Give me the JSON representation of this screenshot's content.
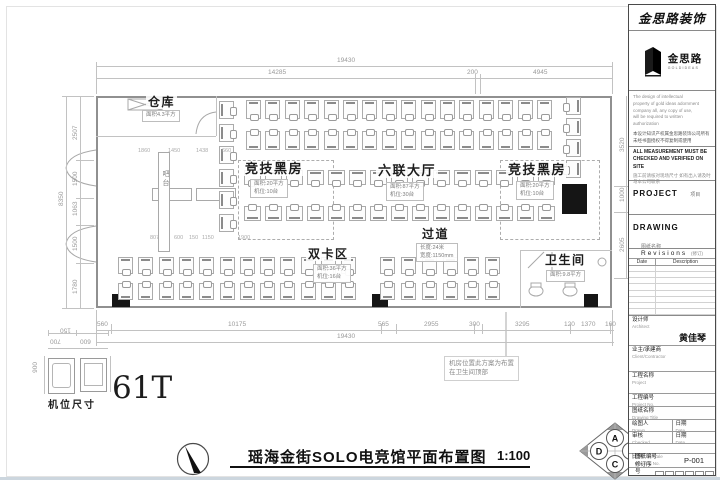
{
  "plan": {
    "rooms": [
      {
        "id": "warehouse",
        "label": "仓库",
        "fs": 12,
        "x": 146,
        "y": 96,
        "note": [
          "面积4.3平方"
        ],
        "nx": 142,
        "ny": 110
      },
      {
        "id": "dark-room-left",
        "label": "竞技黑房",
        "fs": 13,
        "x": 243,
        "y": 162,
        "note": [
          "面积:20平方",
          "机位:10台"
        ],
        "nx": 250,
        "ny": 179
      },
      {
        "id": "hall",
        "label": "六联大厅",
        "fs": 13,
        "x": 376,
        "y": 164,
        "note": [
          "面积:87平方",
          "机位:30台"
        ],
        "nx": 386,
        "ny": 182
      },
      {
        "id": "dark-room-right",
        "label": "竞技黑房",
        "fs": 13,
        "x": 506,
        "y": 163,
        "note": [
          "面积:20平方",
          "机位:10台"
        ],
        "nx": 516,
        "ny": 181
      },
      {
        "id": "corridor",
        "label": "过道",
        "fs": 12,
        "x": 420,
        "y": 228,
        "note": [
          "长度:24米",
          "宽度:1150mm"
        ],
        "nx": 416,
        "ny": 243
      },
      {
        "id": "dual-card-zone",
        "label": "双卡区",
        "fs": 12,
        "x": 306,
        "y": 248,
        "note": [
          "面积:36平方",
          "机位:16台"
        ],
        "nx": 313,
        "ny": 264
      },
      {
        "id": "restroom",
        "label": "卫生间",
        "fs": 12,
        "x": 543,
        "y": 254,
        "note": [
          "面积:9.8平方"
        ],
        "nx": 546,
        "ny": 270
      }
    ],
    "bar_label": "吧台",
    "machine_note": [
      "机房位置此方案为布置",
      "在卫生间顶部"
    ],
    "clusters": [
      {
        "x": 246,
        "y": 100,
        "n": 16,
        "dx": 19.4,
        "dy": 0,
        "w": 15,
        "h": 19,
        "c": "cb"
      },
      {
        "x": 246,
        "y": 131,
        "n": 16,
        "dx": 19.4,
        "dy": 0,
        "w": 15,
        "h": 19,
        "c": "ct"
      },
      {
        "x": 219,
        "y": 101,
        "n": 6,
        "dx": 0,
        "dy": 22.5,
        "w": 15,
        "h": 18,
        "c": "cr"
      },
      {
        "x": 566,
        "y": 97,
        "n": 4,
        "dx": 0,
        "dy": 21,
        "w": 15,
        "h": 18,
        "c": "cl"
      },
      {
        "x": 244,
        "y": 170,
        "n": 15,
        "dx": 21,
        "dy": 0,
        "w": 17,
        "h": 15,
        "c": "cb"
      },
      {
        "x": 244,
        "y": 206,
        "n": 15,
        "dx": 21,
        "dy": 0,
        "w": 17,
        "h": 15,
        "c": "ct"
      },
      {
        "x": 118,
        "y": 257,
        "n": 12,
        "dx": 20.3,
        "dy": 0,
        "w": 15,
        "h": 17,
        "c": "cb"
      },
      {
        "x": 118,
        "y": 283,
        "n": 12,
        "dx": 20.3,
        "dy": 0,
        "w": 15,
        "h": 17,
        "c": "ct"
      },
      {
        "x": 380,
        "y": 257,
        "n": 6,
        "dx": 21,
        "dy": 0,
        "w": 15,
        "h": 17,
        "c": "cb"
      },
      {
        "x": 380,
        "y": 283,
        "n": 6,
        "dx": 21,
        "dy": 0,
        "w": 15,
        "h": 17,
        "c": "ct"
      }
    ],
    "dims": [
      {
        "t": "19430",
        "x": 337,
        "y": 58
      },
      {
        "t": "14285",
        "x": 268,
        "y": 70
      },
      {
        "t": "200",
        "x": 467,
        "y": 70
      },
      {
        "t": "4945",
        "x": 533,
        "y": 70
      },
      {
        "t": "560",
        "x": 97,
        "y": 322
      },
      {
        "t": "10175",
        "x": 228,
        "y": 322
      },
      {
        "t": "565",
        "x": 378,
        "y": 322
      },
      {
        "t": "2955",
        "x": 424,
        "y": 322
      },
      {
        "t": "300",
        "x": 469,
        "y": 322
      },
      {
        "t": "3295",
        "x": 515,
        "y": 322
      },
      {
        "t": "120",
        "x": 564,
        "y": 322
      },
      {
        "t": "1370",
        "x": 581,
        "y": 322
      },
      {
        "t": "160",
        "x": 605,
        "y": 322
      },
      {
        "t": "19430",
        "x": 337,
        "y": 334
      },
      {
        "t": "2507",
        "x": 73,
        "y": 140,
        "cls": "rot"
      },
      {
        "t": "1500",
        "x": 73,
        "y": 186,
        "cls": "rot"
      },
      {
        "t": "1063",
        "x": 73,
        "y": 216,
        "cls": "rot"
      },
      {
        "t": "1500",
        "x": 73,
        "y": 251,
        "cls": "rot"
      },
      {
        "t": "1780",
        "x": 73,
        "y": 294,
        "cls": "rot"
      },
      {
        "t": "8350",
        "x": 59,
        "y": 206,
        "cls": "rot"
      },
      {
        "t": "3520",
        "x": 620,
        "y": 152,
        "cls": "rot"
      },
      {
        "t": "1000",
        "x": 620,
        "y": 202,
        "cls": "rot"
      },
      {
        "t": "2605",
        "x": 620,
        "y": 252,
        "cls": "rot"
      },
      {
        "t": "6325",
        "x": 632,
        "y": 202,
        "cls": "rot"
      },
      {
        "t": "1860",
        "x": 138,
        "y": 149,
        "cls": "tiny"
      },
      {
        "t": "1450",
        "x": 168,
        "y": 149,
        "cls": "tiny"
      },
      {
        "t": "1438",
        "x": 196,
        "y": 149,
        "cls": "tiny"
      },
      {
        "t": "660",
        "x": 222,
        "y": 149,
        "cls": "tiny"
      },
      {
        "t": "807",
        "x": 150,
        "y": 236,
        "cls": "tiny"
      },
      {
        "t": "600",
        "x": 174,
        "y": 236,
        "cls": "tiny"
      },
      {
        "t": "150",
        "x": 189,
        "y": 236,
        "cls": "tiny"
      },
      {
        "t": "1150",
        "x": 202,
        "y": 236,
        "cls": "tiny"
      },
      {
        "t": "1900",
        "x": 238,
        "y": 236,
        "cls": "tiny"
      },
      {
        "t": "150",
        "x": 60,
        "y": 326,
        "cls": "rot180"
      },
      {
        "t": "700",
        "x": 50,
        "y": 337,
        "cls": "rot180"
      },
      {
        "t": "600",
        "x": 80,
        "y": 337,
        "cls": "rot180"
      },
      {
        "t": "900",
        "x": 33,
        "y": 362,
        "cls": "vert"
      },
      {
        "t": "800",
        "x": 103,
        "y": 362,
        "cls": "vert"
      }
    ],
    "seat_detail": {
      "caption": "机位尺寸",
      "total_label": "61T"
    },
    "footer": {
      "title": "瑶海金街SOLO电竞馆平面布置图",
      "scale": "1:100"
    },
    "elevation_marker": {
      "a": "A",
      "b": "B",
      "c": "C",
      "d": "D"
    }
  },
  "title_block": {
    "brand": "金思路装饰",
    "logo": {
      "name": "金思路",
      "sub": "GOLDIDEAS"
    },
    "disclaimer_en": [
      "The design of intellectual",
      "property of gold ideas adornment",
      "company all, any copy of use,",
      "will be required to written",
      "authorization"
    ],
    "disclaimer_cn": [
      "本设计知识产权属金思路装饰公司所有",
      "未经书面授权不得复制或使用"
    ],
    "site_note_en": "ALL MEASUREMENT MUST BE CHECKED AND VERIFIED ON SITE",
    "site_note_cn": "施工前请核对现场尺寸 如有出入请及时与本公司联系",
    "project_label": "PROJECT",
    "project_label_cn": "项目",
    "drawing_label": "DRAWING",
    "drawing_label_cn": "图纸名称",
    "revisions": {
      "title": "Revisions",
      "title_cn": "(修订)",
      "date": "Date",
      "description": "Description"
    },
    "fields": {
      "architect_cn": "设计师",
      "architect_en": "Architect",
      "architect_value": "黄佳琴",
      "client_cn": "业主/承建商",
      "client_en": "Client/Contractor",
      "project_cn": "工程名称",
      "project_en": "Project",
      "project_no_cn": "工程编号",
      "project_no_en": "Project No.",
      "drawing_title_cn": "图纸名称",
      "drawing_title_en": "Drawing Title",
      "drawn_cn": "绘图人",
      "drawn_en": "Drawn",
      "date_cn": "日期",
      "date_en": "Date",
      "checked_cn": "审核",
      "checked_en": "Checked",
      "scale_cn": "比例",
      "scale_en": "Scale",
      "drawing_no_cn": "图纸编号",
      "drawing_no_en": "Drawing No.",
      "drawing_no_value": "P-001",
      "revision_no_cn": "修订序号",
      "revision_no_en": "Revision No."
    }
  }
}
